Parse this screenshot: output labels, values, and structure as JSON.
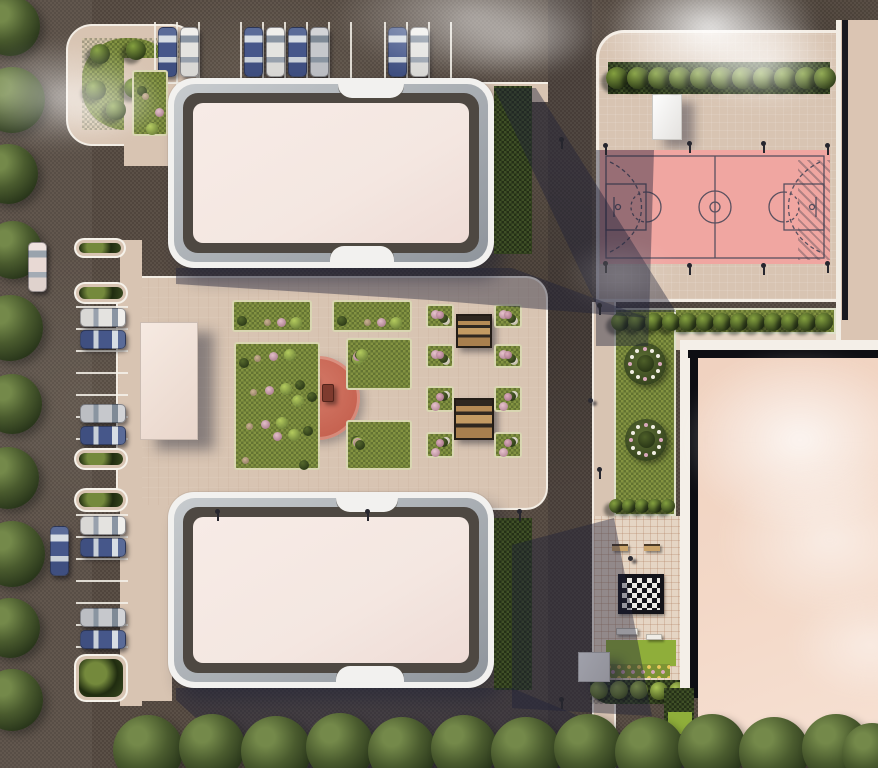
{
  "title": "Aerial 3D site plan rendering of a residential complex with two apartment buildings, courtyard playground, basketball court, chess plaza and parking",
  "palette": {
    "asphalt": "#564b42",
    "pavement": "#d8c4b2",
    "pavement_light": "#e5d5c4",
    "roof_pink": "#f4e7e1",
    "building_white": "#f2f1ef",
    "building_dark": "#4e4842",
    "grass": "#7d8c3e",
    "hedge_dark": "#31401f",
    "lawn_bright": "#8fae3a",
    "court_pink": "#f0a6a1",
    "court_line": "#3f4254",
    "playground_red": "#c5614f",
    "right_roof": "#f3d8c7",
    "shadow_c": "rgba(30,34,58,0.42)",
    "car_blue": "#46578a",
    "car_white": "#e9e8e5",
    "car_silver": "#c9cacd",
    "chess_dark": "#17171d",
    "chess_light": "#ecebe6"
  },
  "collections": {
    "top_parking": {
      "line_y": 22,
      "line_len": 64,
      "car_y": 27,
      "lines": [
        154,
        176,
        198,
        240,
        262,
        284,
        306,
        328,
        350,
        384,
        406,
        428,
        450
      ],
      "cars": [
        [
          158,
          "blue"
        ],
        [
          180,
          "white"
        ],
        [
          244,
          "blue"
        ],
        [
          266,
          "white"
        ],
        [
          288,
          "blue"
        ],
        [
          310,
          "silver"
        ],
        [
          388,
          "blue"
        ],
        [
          410,
          "white"
        ]
      ]
    },
    "left_bays": {
      "line_x": 76,
      "line_len": 52,
      "car_x": 80,
      "lines": [
        306,
        328,
        350,
        372,
        394,
        416,
        438,
        514,
        536,
        558,
        580,
        602,
        624,
        646
      ],
      "cars": [
        [
          308,
          "white"
        ],
        [
          330,
          "blue"
        ],
        [
          404,
          "silver"
        ],
        [
          426,
          "blue"
        ],
        [
          516,
          "white"
        ],
        [
          538,
          "blue"
        ],
        [
          608,
          "silver"
        ],
        [
          630,
          "blue"
        ]
      ]
    },
    "planters": [
      [
        74,
        238,
        52,
        20
      ],
      [
        74,
        282,
        54,
        22
      ],
      [
        74,
        448,
        54,
        22
      ],
      [
        74,
        488,
        54,
        24
      ],
      [
        74,
        654,
        54,
        48
      ]
    ],
    "street_cars": [
      [
        28,
        242,
        "pearl"
      ],
      [
        50,
        526,
        "blue"
      ]
    ],
    "left_trees": [
      [
        10,
        26,
        30
      ],
      [
        12,
        100,
        33
      ],
      [
        8,
        174,
        30
      ],
      [
        13,
        250,
        29
      ],
      [
        10,
        328,
        33
      ],
      [
        12,
        404,
        30
      ],
      [
        8,
        478,
        31
      ],
      [
        12,
        554,
        33
      ],
      [
        10,
        628,
        30
      ],
      [
        12,
        700,
        31
      ]
    ],
    "bottom_trees": [
      [
        148,
        750,
        35
      ],
      [
        212,
        747,
        33
      ],
      [
        276,
        751,
        35
      ],
      [
        340,
        747,
        34
      ],
      [
        402,
        751,
        34
      ],
      [
        464,
        748,
        33
      ],
      [
        526,
        752,
        35
      ],
      [
        588,
        748,
        34
      ],
      [
        650,
        752,
        35
      ],
      [
        712,
        748,
        34
      ],
      [
        774,
        752,
        35
      ],
      [
        836,
        748,
        34
      ],
      [
        872,
        753,
        30
      ]
    ],
    "hedgeA_trees": [
      [
        512,
        108,
        13
      ],
      [
        511,
        148,
        12
      ],
      [
        513,
        192,
        13
      ],
      [
        511,
        232,
        12
      ]
    ],
    "hedgeB_bushes": [
      [
        512,
        532,
        10
      ],
      [
        512,
        556,
        10
      ],
      [
        512,
        580,
        10
      ],
      [
        512,
        604,
        10
      ],
      [
        512,
        628,
        10
      ],
      [
        512,
        652,
        10
      ],
      [
        512,
        676,
        10
      ]
    ],
    "plaza_hedge": {
      "y": 78,
      "r": 11,
      "xs": [
        617,
        638,
        659,
        680,
        701,
        722,
        743,
        764,
        785,
        806,
        825
      ]
    },
    "lstrip_hedge": {
      "y": 322,
      "r": 9,
      "xs": [
        620,
        637,
        654,
        671,
        688,
        705,
        722,
        739,
        756,
        773,
        790,
        807,
        824
      ]
    },
    "mid_hedge": {
      "y": 506,
      "r": 7,
      "xs": [
        616,
        629,
        642,
        655,
        668
      ]
    },
    "corner_bushes": {
      "r": 10,
      "pts": [
        [
          100,
          54
        ],
        [
          136,
          50
        ],
        [
          96,
          90
        ],
        [
          134,
          88
        ],
        [
          116,
          110
        ]
      ]
    },
    "beds": [
      [
        132,
        70,
        36,
        66
      ],
      [
        232,
        300,
        80,
        32
      ],
      [
        332,
        300,
        80,
        32
      ],
      [
        234,
        342,
        86,
        128
      ],
      [
        346,
        338,
        66,
        52
      ],
      [
        346,
        420,
        66,
        50
      ]
    ],
    "pergola_beds": [
      [
        426,
        304,
        28,
        24
      ],
      [
        494,
        304,
        28,
        24
      ],
      [
        426,
        344,
        28,
        24
      ],
      [
        494,
        344,
        28,
        24
      ],
      [
        426,
        386,
        28,
        26
      ],
      [
        494,
        386,
        28,
        26
      ],
      [
        426,
        432,
        28,
        26
      ],
      [
        494,
        432,
        28,
        26
      ]
    ],
    "flower_circles": [
      [
        645,
        364,
        21
      ],
      [
        646,
        440,
        21
      ]
    ],
    "bush_row": [
      [
        599,
        690
      ],
      [
        619,
        690
      ],
      [
        639,
        690
      ],
      [
        659,
        691
      ],
      [
        678,
        691
      ]
    ],
    "poles": [
      [
        560,
        140
      ],
      [
        598,
        306
      ],
      [
        216,
        512
      ],
      [
        366,
        512
      ],
      [
        518,
        512
      ],
      [
        598,
        470
      ],
      [
        604,
        146
      ],
      [
        688,
        144
      ],
      [
        762,
        144
      ],
      [
        826,
        146
      ],
      [
        604,
        264
      ],
      [
        688,
        266
      ],
      [
        762,
        266
      ],
      [
        826,
        264
      ],
      [
        560,
        700
      ]
    ],
    "people": [
      [
        588,
        398
      ],
      [
        628,
        556
      ]
    ]
  }
}
